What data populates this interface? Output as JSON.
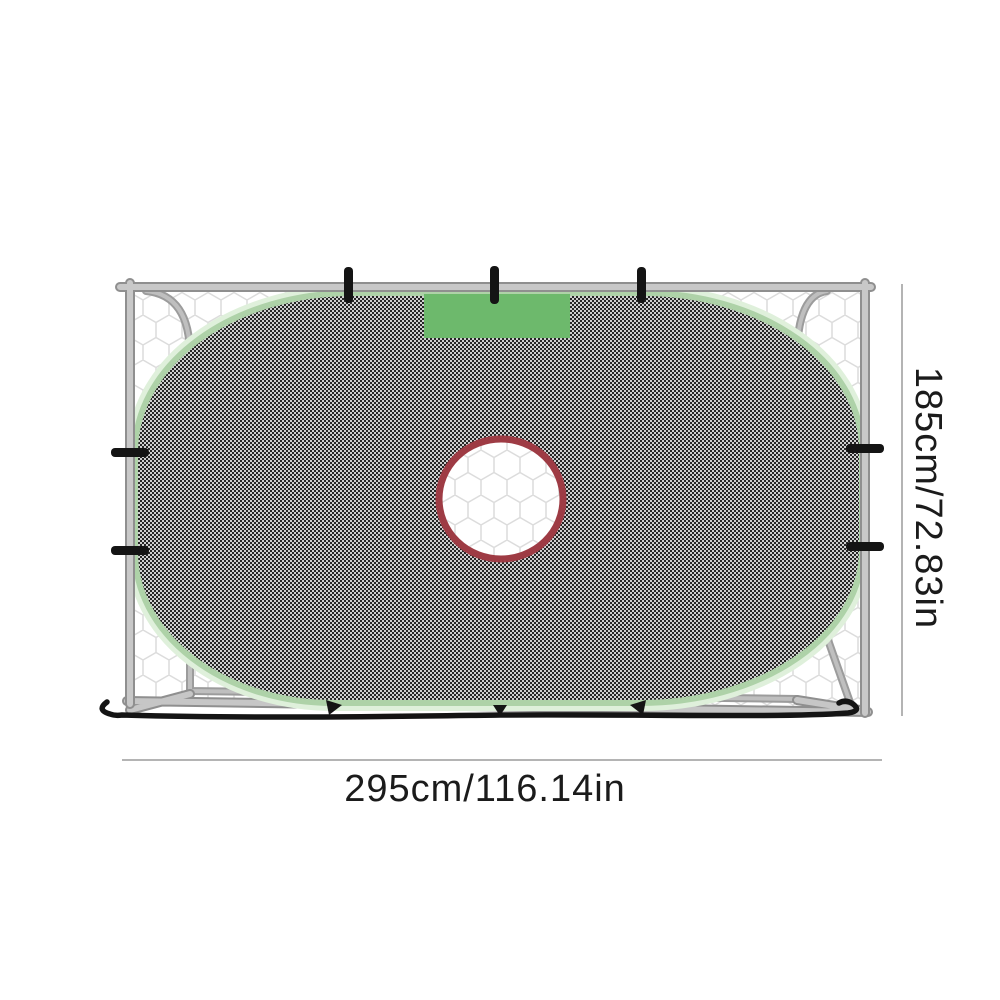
{
  "image_type": "product-photo-with-dimensions",
  "product": "soccer goal target shooting net",
  "annotations": {
    "height_label": "185cm/72.83in",
    "width_label": "295cm/116.14in"
  },
  "colors": {
    "background": "#ffffff",
    "frame_tube_light": "#c6c6c6",
    "frame_tube_edge": "#8f8f8f",
    "rear_tube": "#9c9c9c",
    "net_line": "#dcdcdc",
    "mesh_dark": "#262626",
    "mesh_light": "#cfcfcf",
    "trim_green": "#aed2a8",
    "trim_halo_green": "#dff0db",
    "patch_green": "#6db96c",
    "ring_red": "#9e3b44",
    "strap_black": "#141414",
    "dimension_line": "#9b9b9b",
    "text": "#1b1b1b"
  }
}
